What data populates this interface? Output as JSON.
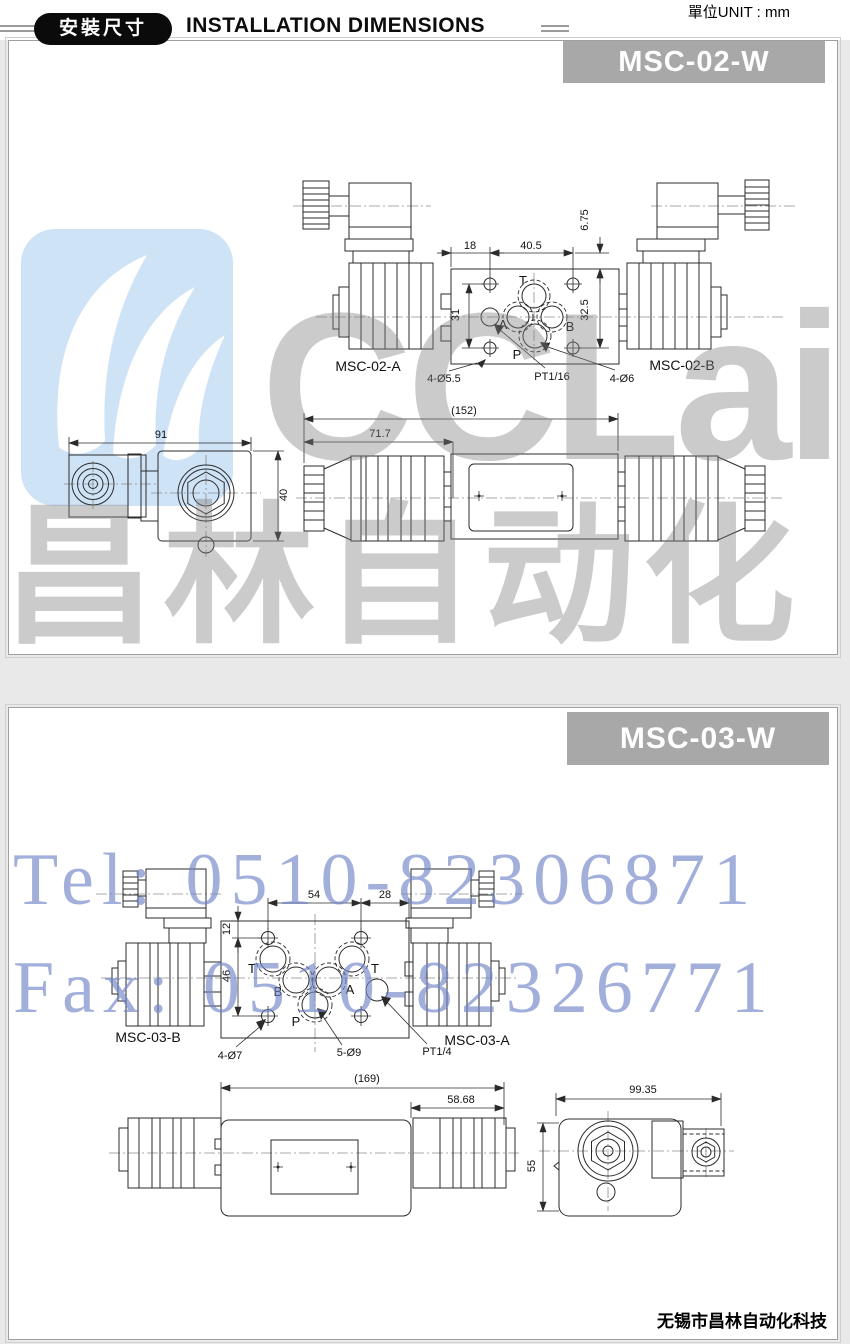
{
  "colors": {
    "banner_gray": "#a8a8a8",
    "drawing_ink": "#2b2b2b",
    "watermark_blue": "#7284c7",
    "watermark_gray": "#7d7d7d",
    "logo_blue": "#cfe3f7"
  },
  "header": {
    "unit": "單位UNIT : mm",
    "badge": "安裝尺寸",
    "title": "INSTALLATION DIMENSIONS"
  },
  "watermark": {
    "brand": "CCLair",
    "brand_cn": "昌林自动化",
    "tel": "Tel: 0510-82306871",
    "fax": "Fax: 0510-82326771"
  },
  "footer": {
    "company": "无锡市昌林自动化科技"
  },
  "msc02": {
    "model": "MSC-02-W",
    "left_unit": "MSC-02-A",
    "right_unit": "MSC-02-B",
    "ports": {
      "t": "T",
      "a": "A",
      "b": "B",
      "p": "P"
    },
    "dims": {
      "top_left": "18",
      "top_right": "40.5",
      "side_offset": "6.75",
      "left_height": "31",
      "right_height": "32.5",
      "total_length": "(152)",
      "left_length": "71.7",
      "side_width": "91",
      "side_height": "40"
    },
    "notes": {
      "mount_holes": "4-Ø5.5",
      "thread": "PT1/16",
      "pin_holes": "4-Ø6"
    }
  },
  "msc03": {
    "model": "MSC-03-W",
    "left_unit": "MSC-03-B",
    "right_unit": "MSC-03-A",
    "ports": {
      "t1": "T",
      "b": "B",
      "a": "A",
      "t2": "T",
      "p": "P"
    },
    "dims": {
      "top_left": "54",
      "top_right": "28",
      "top_offset": "12",
      "left_height": "46",
      "total_length": "(169)",
      "right_length": "58.68",
      "side_width": "99.35",
      "side_height": "55"
    },
    "notes": {
      "mount_holes": "4-Ø7",
      "port_holes": "5-Ø9",
      "thread": "PT1/4"
    }
  }
}
